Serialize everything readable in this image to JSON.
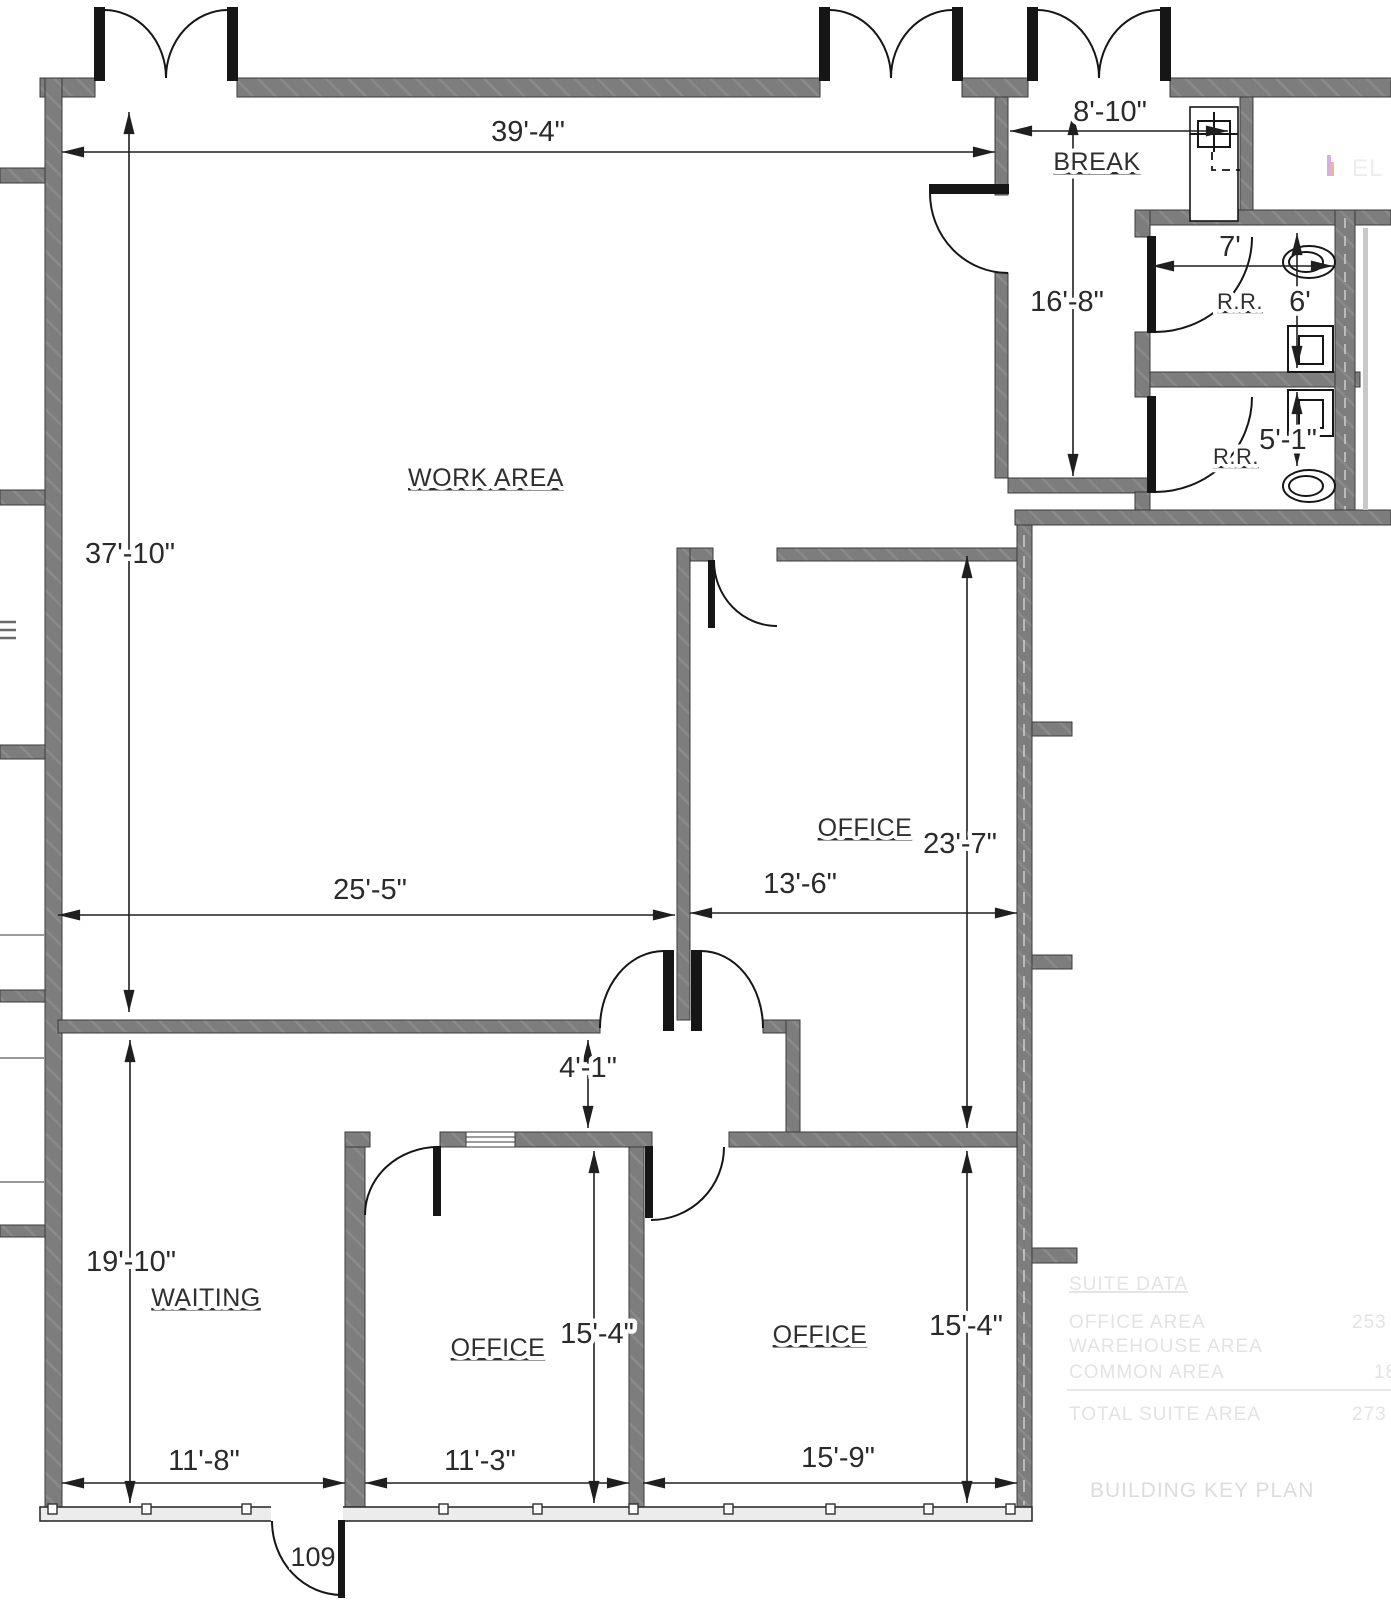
{
  "plan_title": "office suite floor plan",
  "labels": {
    "work_area": "WORK AREA",
    "break_room": "BREAK",
    "restroom_upper": "R.R.",
    "restroom_lower": "R.R.",
    "office_ne": "OFFICE",
    "waiting": "WAITING",
    "office_sw": "OFFICE",
    "office_se": "OFFICE",
    "entry_door_number": "109"
  },
  "dimensions": {
    "top_width": "39'-4\"",
    "break_width": "8'-10\"",
    "break_depth": "16'-8\"",
    "rr_width": "7'",
    "rr_upper_depth": "6'",
    "rr_lower_width": "5'-1\"",
    "work_depth": "37'-10\"",
    "work_width": "25'-5\"",
    "office_ne_width": "13'-6\"",
    "office_ne_depth": "23'-7\"",
    "hall_width": "4'-1\"",
    "waiting_depth": "19'-10\"",
    "office_sw_depth": "15'-4\"",
    "office_se_depth": "15'-4\"",
    "waiting_width": "11'-8\"",
    "office_sw_width": "11'-3\"",
    "office_se_width": "15'-9\""
  },
  "ghost_panel": {
    "title": "SUITE DATA",
    "rows": [
      {
        "label": "OFFICE AREA",
        "value": "253"
      },
      {
        "label": "WAREHOUSE AREA",
        "value": ""
      },
      {
        "label": "COMMON AREA",
        "value": "18"
      }
    ],
    "total_row": {
      "label": "TOTAL SUITE AREA",
      "value": "273"
    },
    "caption": "BUILDING KEY PLAN",
    "side_note": "EL"
  },
  "colors": {
    "wall_gray": "#7d7d7d",
    "line_dark": "#1f1f1f",
    "ghost_gray": "#e3e3e3",
    "storefront_gray": "#ececec",
    "mark_pink": "#d49fd6",
    "mark_tan": "#dfb27a"
  }
}
